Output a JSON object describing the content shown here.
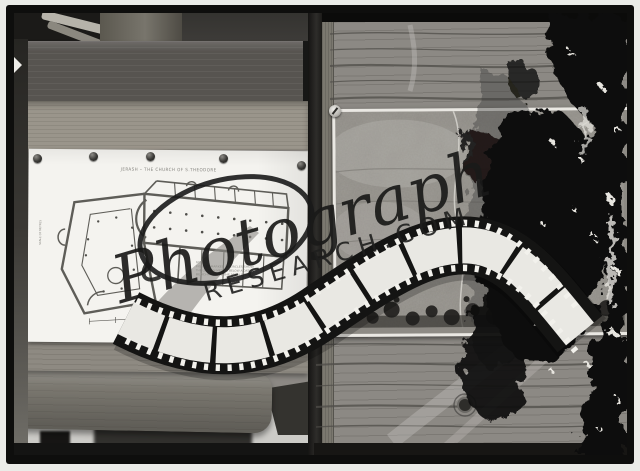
{
  "artifact": {
    "plan_sheet": {
      "title": "JERASH – THE CHURCH OF S.THEODORE",
      "note_lines": [
        "NOTE —",
        "FIGURES MARKED IN CIRCLES SHOW",
        "THE LEVEL IN METRES BELOW A DATUM",
        "BENCHMARK IN THE MAIN STREET"
      ],
      "side_label": "SCALE OF METRES"
    }
  },
  "watermark": {
    "script_word": "Photograph",
    "domain_word": "RESEARCH.COM"
  },
  "colors": {
    "margin": "#ebece8",
    "frame_black": "#0e0e0d",
    "paper": "#f4f3ef",
    "wood_light": "#9a958b",
    "wood_mid": "#8c8984",
    "wood_dark": "#575450",
    "film_frame": "#e9e8e3",
    "damage_black": "#0d0d0c"
  }
}
